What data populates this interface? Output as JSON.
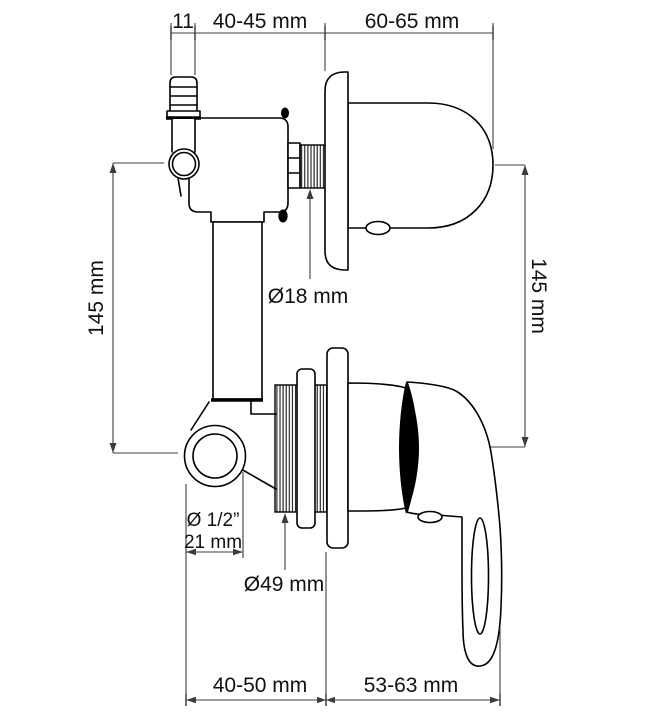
{
  "colors": {
    "background": "#ffffff",
    "line": "#000000",
    "dimension_line": "#3c3c3c",
    "text": "#111111"
  },
  "labels": {
    "top_small": "11",
    "top_left": "40-45 mm",
    "top_right": "60-65 mm",
    "left_height": "145 mm",
    "right_height": "145 mm",
    "thread_diameter": "Ø18 mm",
    "port_thread": "Ø 1/2”",
    "port_diameter": "21 mm",
    "flange_diameter": "Ø49 mm",
    "bottom_left": "40-50 mm",
    "bottom_right": "53-63 mm"
  }
}
